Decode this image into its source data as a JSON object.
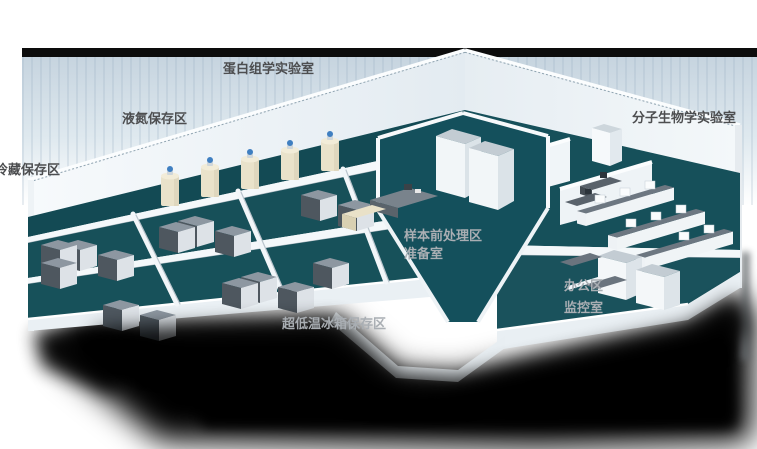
{
  "floorplan": {
    "areas": {
      "proteomics_lab": "蛋白组学实验室",
      "liquid_nitrogen_storage": "液氮保存区",
      "cold_storage": "冷藏保存区",
      "molecular_biology_lab": "分子生物学实验室",
      "sample_pretreatment": "样本前处理区",
      "preparation_room": "准备室",
      "office_area": "办公区",
      "monitoring_room": "监控室",
      "ult_freezer_storage": "超低温冰箱保存区"
    },
    "colors": {
      "background": "#ffffff",
      "top_bar": "#0c0c0c",
      "backdrop_blue": "#c6d4df",
      "floor_teal": "#175059",
      "wall_white": "#f2f6f9",
      "freezer_gray": "#8d97a1",
      "dewar_cream": "#e9e2ca",
      "dewar_cap_blue": "#3f7fc1",
      "shadow_black": "#000000",
      "label_dark": "#4d4e50",
      "label_light": "#a9aeb3"
    }
  }
}
